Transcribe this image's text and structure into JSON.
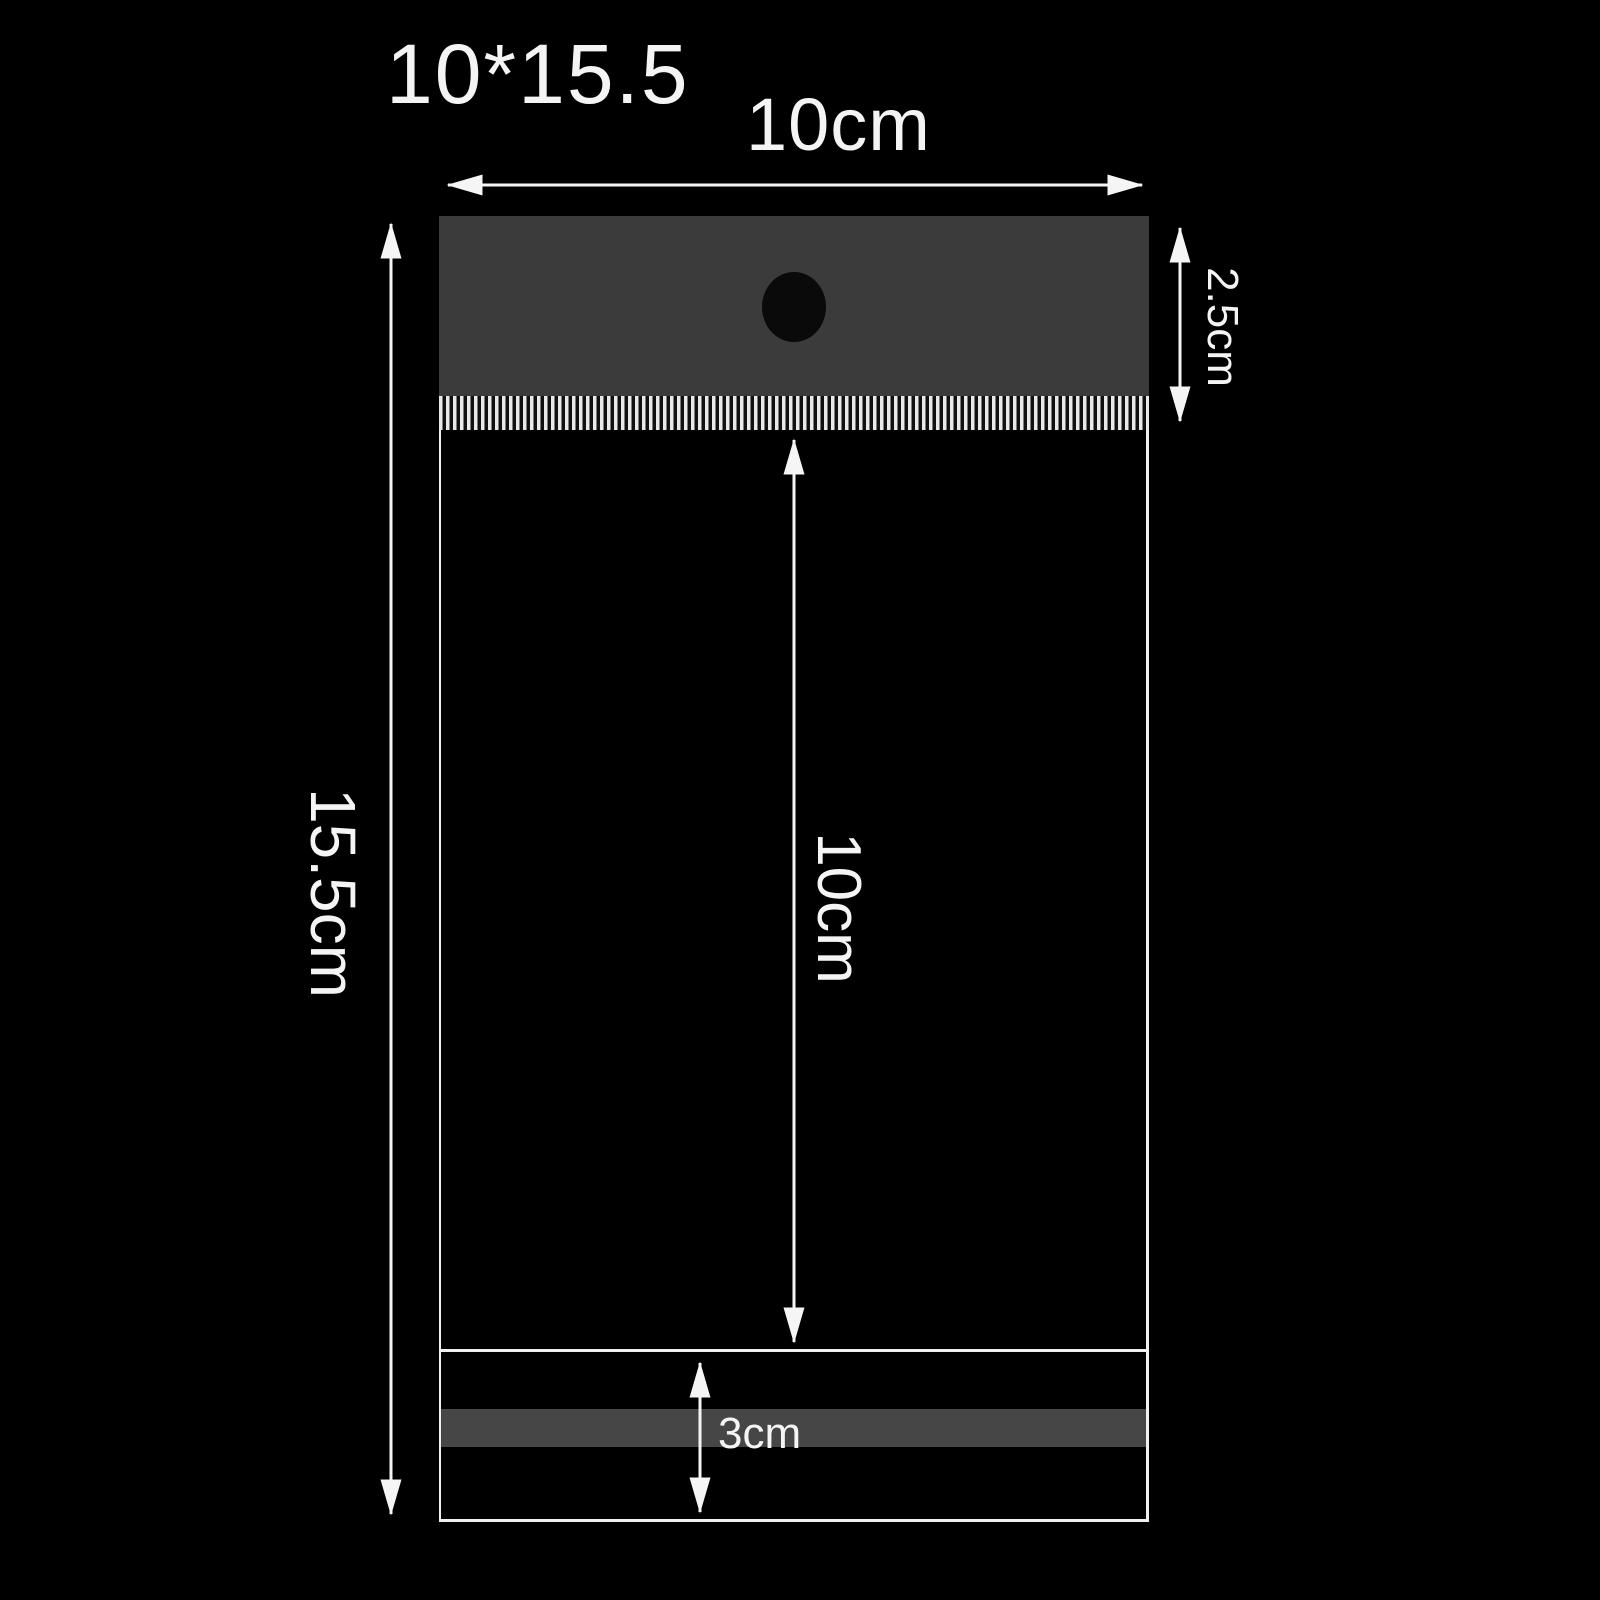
{
  "diagram": {
    "type": "product-dimension-diagram",
    "subject": "self-adhesive hanging header plastic bag"
  },
  "labels": {
    "size_code": "10*15.5",
    "width": "10cm",
    "total_height": "15.5cm",
    "header_height": "2.5cm",
    "body_height": "10cm",
    "flap_height": "3cm"
  },
  "colors": {
    "bg": "#000000",
    "header_fill": "#3b3b3b",
    "hole_fill": "#0a0a0a",
    "band_fill": "#464646",
    "outline": "#f0f0f0",
    "stripe": "#e9e9e9",
    "text": "#f4f4f4",
    "arrow": "#f5f5f5"
  }
}
